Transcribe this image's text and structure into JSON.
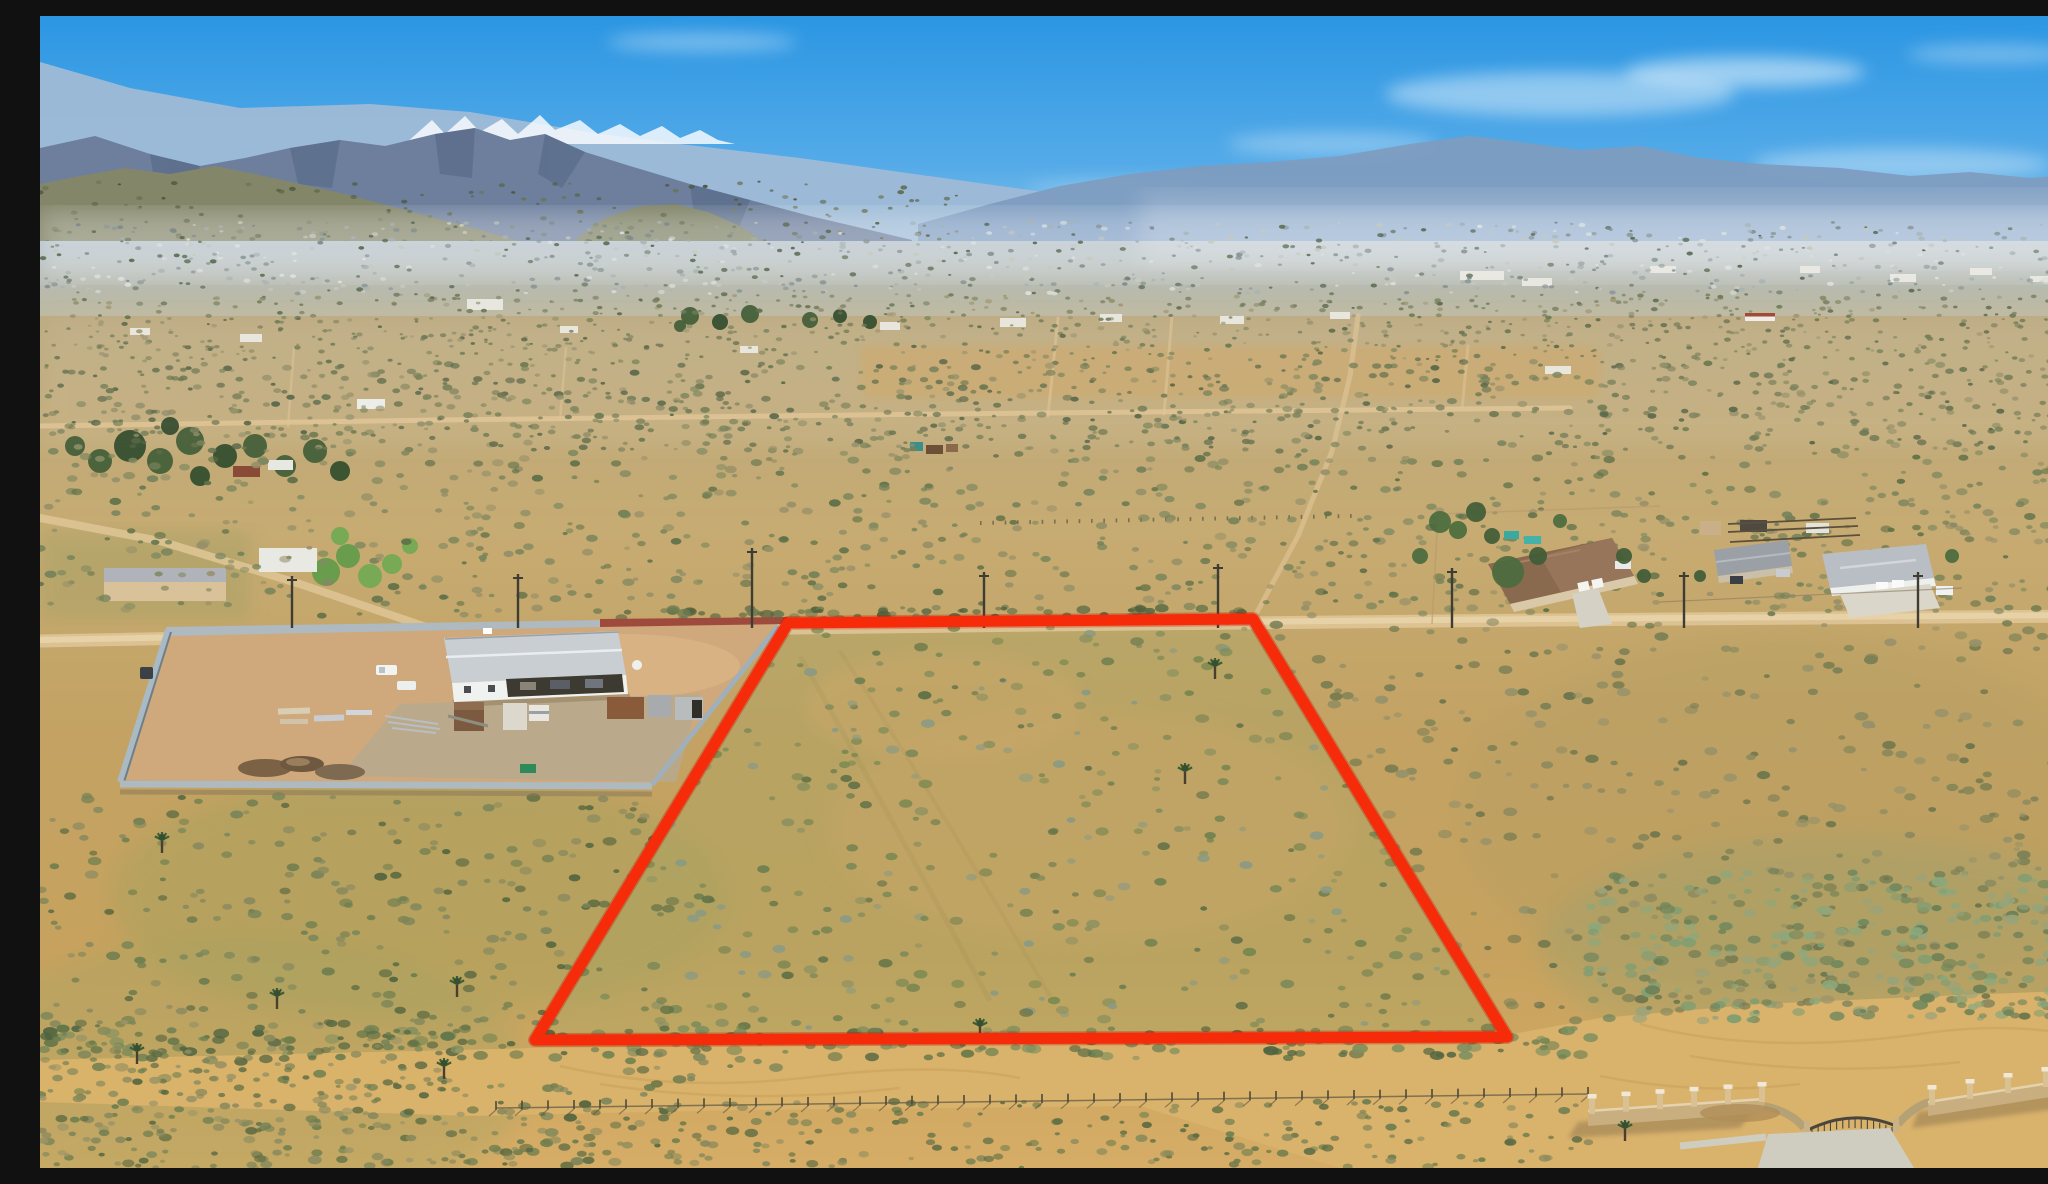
{
  "photo": {
    "description": "Aerial drone photograph of vacant high-desert land with a red property boundary outline, mountains and a distant town on the horizon",
    "width": 2048,
    "height": 1152
  },
  "boundary": {
    "name": "property-boundary",
    "shape": "quadrilateral",
    "color": "#f62b0a",
    "underglow_color": "#c41a04",
    "stroke_width": 11,
    "points": [
      [
        748,
        607
      ],
      [
        1213,
        603
      ],
      [
        1467,
        1021
      ],
      [
        495,
        1024
      ]
    ]
  },
  "palette": {
    "sky_top": "#2b96e3",
    "sky_mid": "#55abe8",
    "sky_low": "#8ec6ec",
    "sky_horizon": "#d6e8f3",
    "cloud": "#ffffff",
    "mtn_far": "#9fbbd6",
    "mtn_main": "#6d7f9d",
    "mtn_facet": "#596b88",
    "snow": "#ffffff",
    "hills_olive": "#84866a",
    "hills_olive2": "#7d8164",
    "hills_dark": "#6e7458",
    "ridge_right": "#7e9cc0",
    "valley_top": "#b2c0ca",
    "valley_mid": "#bdb79c",
    "valley_bot": "#c3ab7e",
    "ground_far": "#bba97f",
    "ground_mid1": "#c6ab72",
    "ground_mid2": "#c3a263",
    "ground_mid3": "#c7a25e",
    "ground_near": "#d6ad66",
    "road": "#dfc597",
    "road_light": "#e8d3a9",
    "sand": "#d9b26c",
    "sand_swirl": "#c89f56",
    "concrete": "#cfccc0",
    "parcel_tint": "#a9a565",
    "green_tint": "#95a05c",
    "wall_gray": "#aeb9c0",
    "wall_gray_dark": "#6f7e88",
    "wall_brick": "#9e4a3c",
    "yard_dirt": "#cfa97b",
    "yard_gravel": "#b7a98f",
    "roof_metal": "#c9ced2",
    "building_white": "#f0f2f0",
    "open_bay_dark": "#3c3a31",
    "container_brown": "#7b5a40",
    "container_rust": "#8a5b3b",
    "container_gray": "#a7abad",
    "container_white": "#ddd8ce",
    "dirt_pile": "#7b6245",
    "dumpster_green": "#2f8a5a",
    "house_tile_roof": "#8a6a4e",
    "house_tan": "#d9c9a8",
    "roof_gray": "#9aa0a6",
    "roof_light": "#b9bec4",
    "block_wall": "#c9ae80",
    "block_wall_cap": "#f0e8d4",
    "shadow": "#8a7a5a",
    "tree_dark": "#3f5c36",
    "tree_darker": "#2f4a2c",
    "tree_green": "#5f9a4a",
    "tree_bright": "#6faa52",
    "teal_playset": "#3aa9a0",
    "pole": "#3f3d33",
    "fence": "#6b6148"
  },
  "landmarks": [
    "sky",
    "clouds",
    "snow-capped-mountains",
    "desert-mountain-range",
    "hazy-blue-ridge",
    "distant-town",
    "desert-plain",
    "dirt-roads",
    "fenced-contractor-yard",
    "white-workshop-building",
    "shipping-containers",
    "material-stacks",
    "dirt-piles",
    "ranch-house-spanish",
    "ranch-house-gray",
    "ranch-house-white",
    "horse-corrals",
    "outlined-vacant-parcel",
    "utility-poles",
    "chain-link-fence",
    "block-wall-with-gate",
    "concrete-apron",
    "joshua-trees",
    "scrub-vegetation",
    "sandy-road"
  ]
}
